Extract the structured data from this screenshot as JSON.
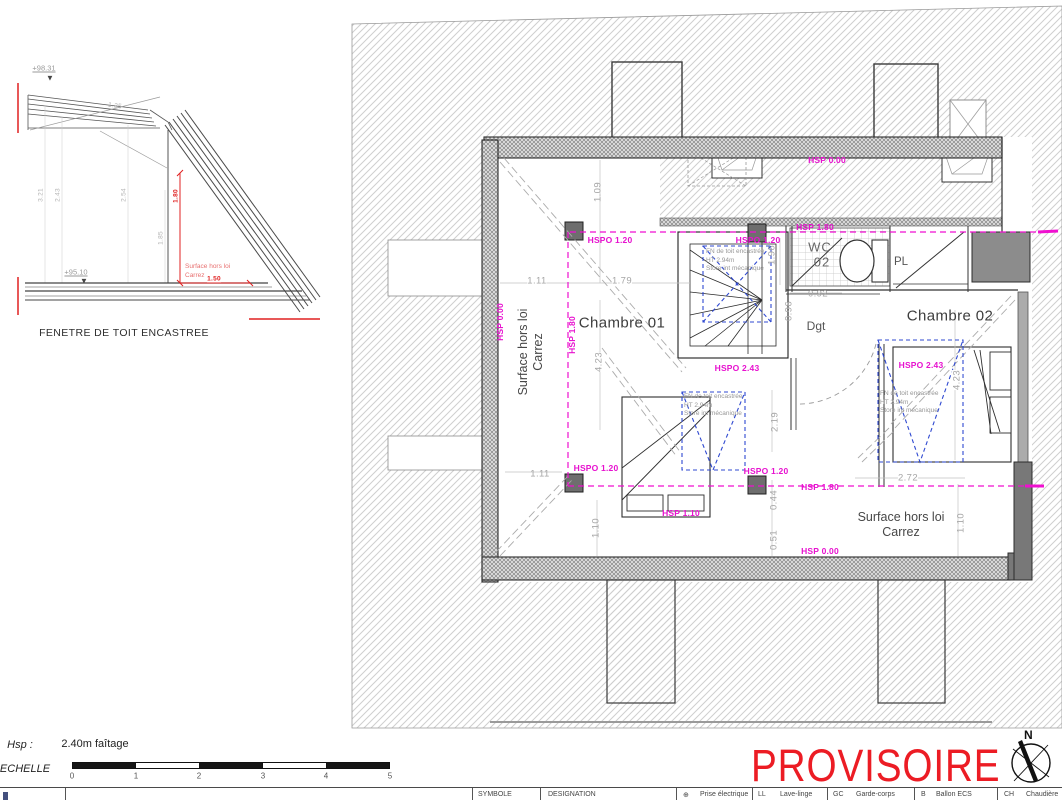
{
  "section": {
    "caption": "FENETRE DE TOIT ENCASTREE",
    "elev_top": "+98.31",
    "elev_floor": "+95.10",
    "slope_dim": "1.25",
    "dim_1": "3.21",
    "dim_2": "2.43",
    "dim_3": "2.54",
    "dim_4": "1.85",
    "red_height": "1.80",
    "red_width": "1.50",
    "note_line1": "Surface hors loi",
    "note_line2": "Carrez"
  },
  "icons": {
    "elevation_marker": "▼"
  },
  "plan": {
    "rooms": {
      "chambre01": "Chambre 01",
      "chambre02": "Chambre 02",
      "wc_line1": "WC",
      "wc_line2": "02",
      "dgt": "Dgt",
      "pl": "PL"
    },
    "carrez_line1": "Surface hors loi",
    "carrez_line2": "Carrez",
    "skylight_note": {
      "l1": "FN de toit encastrée",
      "l2": "HT 2.94m",
      "l3": "Store int mécanique"
    },
    "heights": {
      "hspo120": "HSPO 1.20",
      "hsp180": "HSP 1.80",
      "hsp110": "HSP 1.10",
      "hsp000": "HSP 0.00",
      "hspo243": "HSPO 2.43"
    },
    "dims": {
      "a109": "1.09",
      "a111": "1.11",
      "a179": "1.79",
      "a092": "0.92",
      "a196": "1.96",
      "a096": "0.96",
      "a423": "4.23",
      "a219": "2.19",
      "a044": "0.44",
      "a051": "0.51",
      "a110": "1.10",
      "a272": "2.72"
    }
  },
  "footer": {
    "hsp_label": "Hsp :",
    "hsp_value": "2.40m faîtage",
    "echelle_label": "ECHELLE",
    "ticks": [
      "0",
      "1",
      "2",
      "3",
      "4",
      "5"
    ],
    "provisoire": "PROVISOIRE",
    "north": "N"
  },
  "legend": {
    "col_symbol": "SYMBOLE",
    "col_designation": "DESIGNATION",
    "items": [
      {
        "sym": "⊕",
        "label": "Prise électrique"
      },
      {
        "sym": "LL",
        "label": "Lave-linge"
      },
      {
        "sym": "GC",
        "label": "Garde-corps"
      },
      {
        "sym": "B",
        "label": "Ballon ECS"
      },
      {
        "sym": "CH",
        "label": "Chaudière"
      }
    ]
  }
}
